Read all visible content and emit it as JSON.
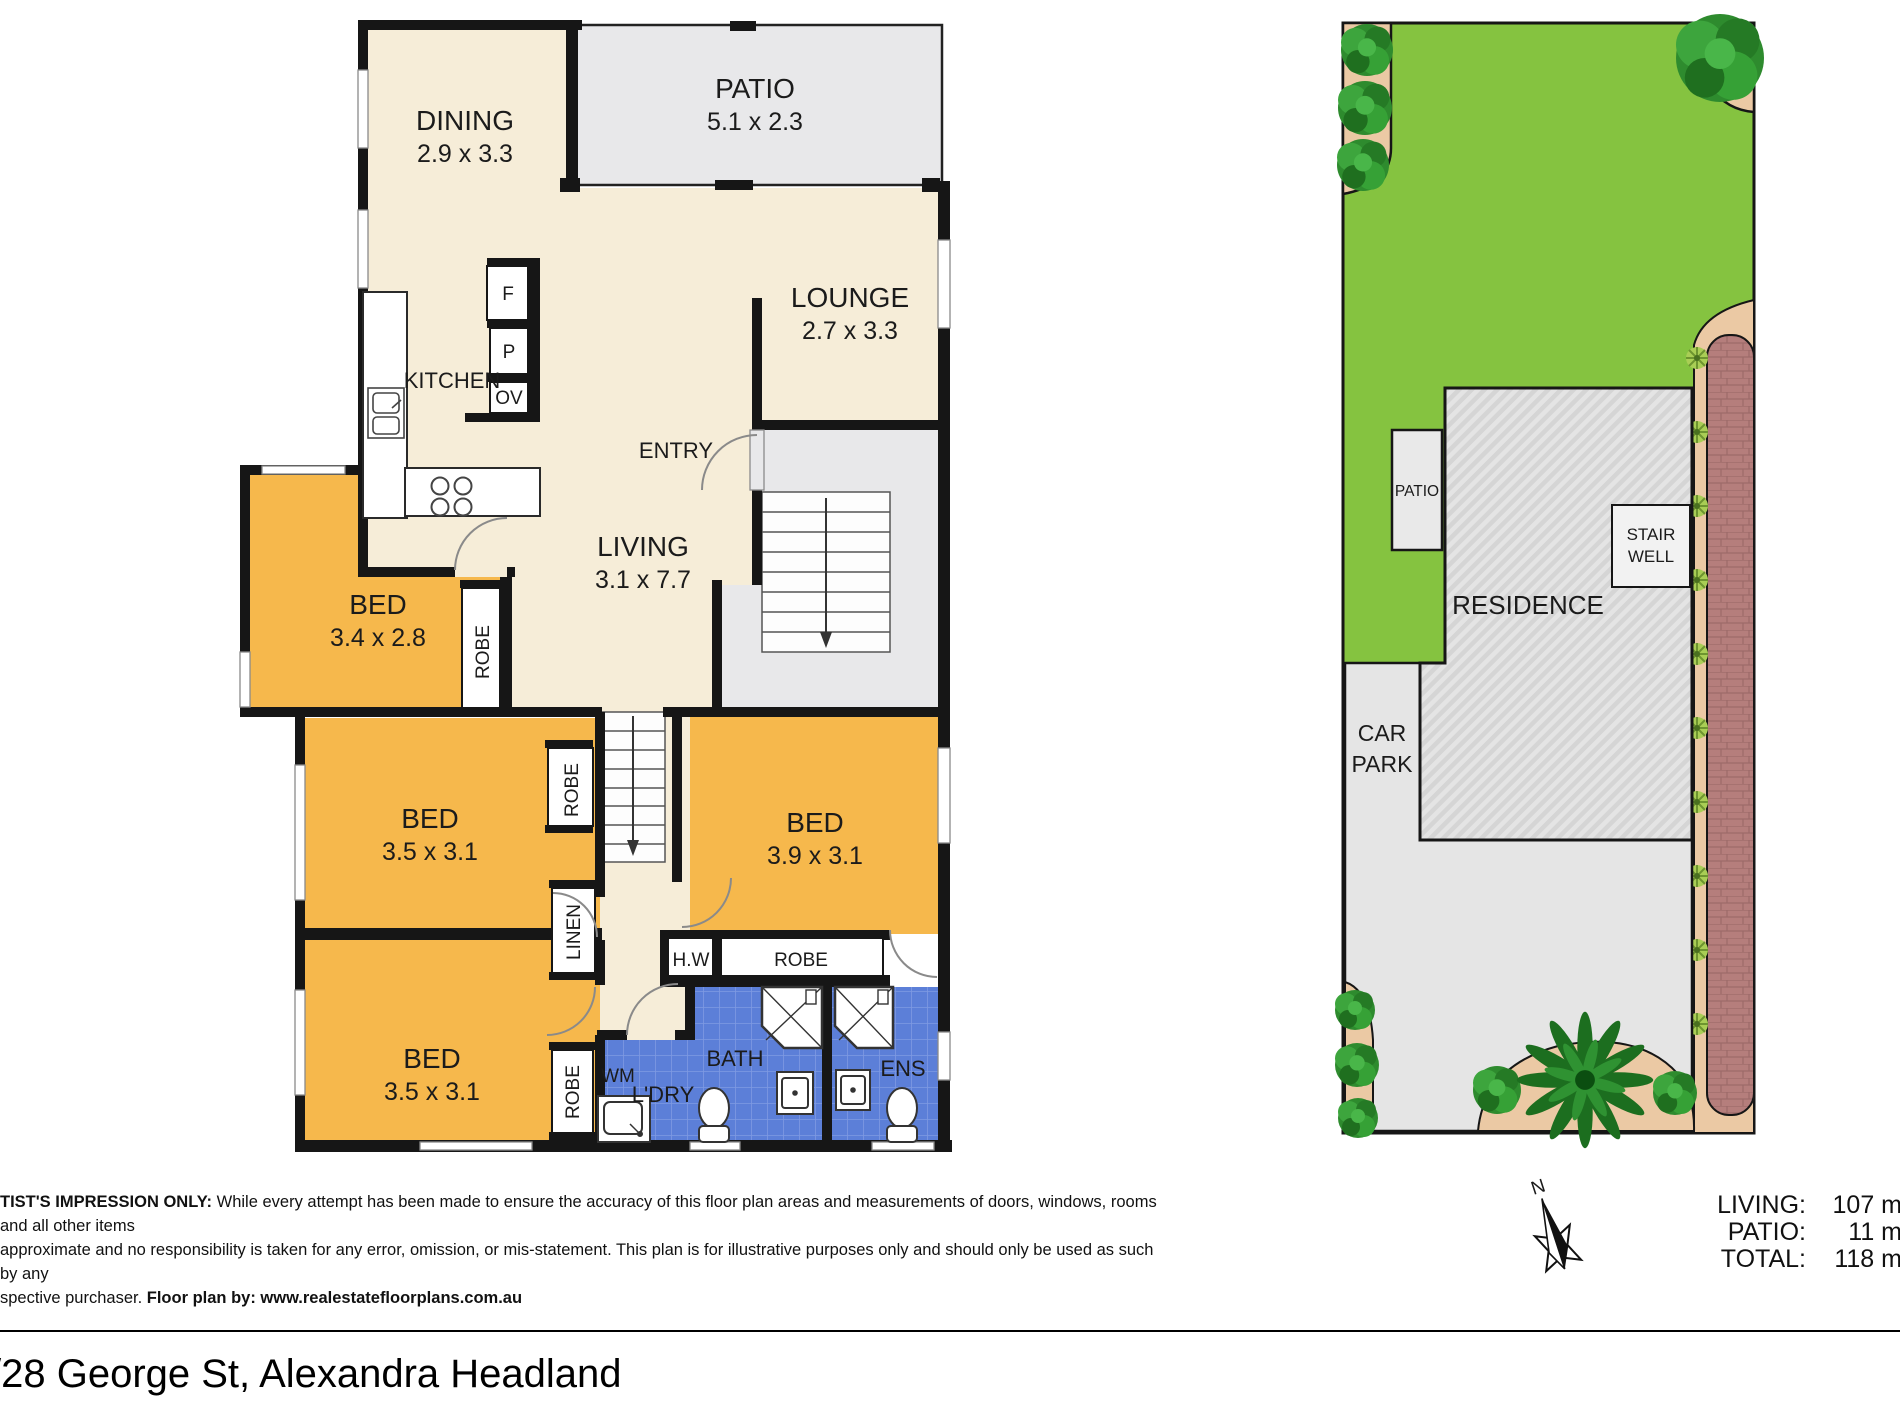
{
  "floorplan": {
    "dining_label": "DINING",
    "dining_dims": "2.9 x 3.3",
    "patio_label": "PATIO",
    "patio_dims": "5.1 x 2.3",
    "lounge_label": "LOUNGE",
    "lounge_dims": "2.7 x 3.3",
    "kitchen_label": "KITCHEN",
    "entry_label": "ENTRY",
    "living_label": "LIVING",
    "living_dims": "3.1 x 7.7",
    "bed1_label": "BED",
    "bed1_dims": "3.4 x 2.8",
    "bed2_label": "BED",
    "bed2_dims": "3.5 x 3.1",
    "bed3_label": "BED",
    "bed3_dims": "3.5 x 3.1",
    "bed4_label": "BED",
    "bed4_dims": "3.9 x 3.1",
    "bath_label": "BATH",
    "ens_label": "ENS",
    "laundry_label": "L'DRY",
    "wm_label": "WM",
    "hw_label": "H.W",
    "linen_label": "LINEN",
    "robe_label": "ROBE",
    "fridge_label": "F",
    "pantry_label": "P",
    "oven_label": "OV"
  },
  "siteplan": {
    "residence_label": "RESIDENCE",
    "patio_label": "PATIO",
    "stairwell_line1": "STAIR",
    "stairwell_line2": "WELL",
    "carpark_line1": "CAR",
    "carpark_line2": "PARK"
  },
  "compass": {
    "north_label": "N"
  },
  "areas": {
    "rows": [
      {
        "label": "LIVING:",
        "value": "107 m"
      },
      {
        "label": "PATIO:",
        "value": "11 m"
      },
      {
        "label": "TOTAL:",
        "value": "118 m"
      }
    ]
  },
  "disclaimer": {
    "bold_intro": "TIST'S IMPRESSION ONLY:",
    "line1_rest": " While every attempt has been made to ensure the accuracy of this floor plan areas and measurements of doors, windows, rooms and all other items",
    "line2": "approximate and no responsibility is taken for any error, omission, or mis-statement. This plan is for illustrative purposes only and should only be used as such by any",
    "line3_prefix": "spective purchaser. ",
    "line3_bold": "Floor plan by: www.realestatefloorplans.com.au"
  },
  "address": "/28 George St, Alexandra Headland",
  "colors": {
    "wall": "#161616",
    "cream": "#F6EDD8",
    "orange": "#F6B84C",
    "tile_blue": "#5C7FD8",
    "plan_gray": "#E8E8EA",
    "lawn_green": "#85C340",
    "garden_tan": "#EBC9A4",
    "brick_path": "#B57E7C",
    "paving_gray": "#E5E5E5"
  }
}
